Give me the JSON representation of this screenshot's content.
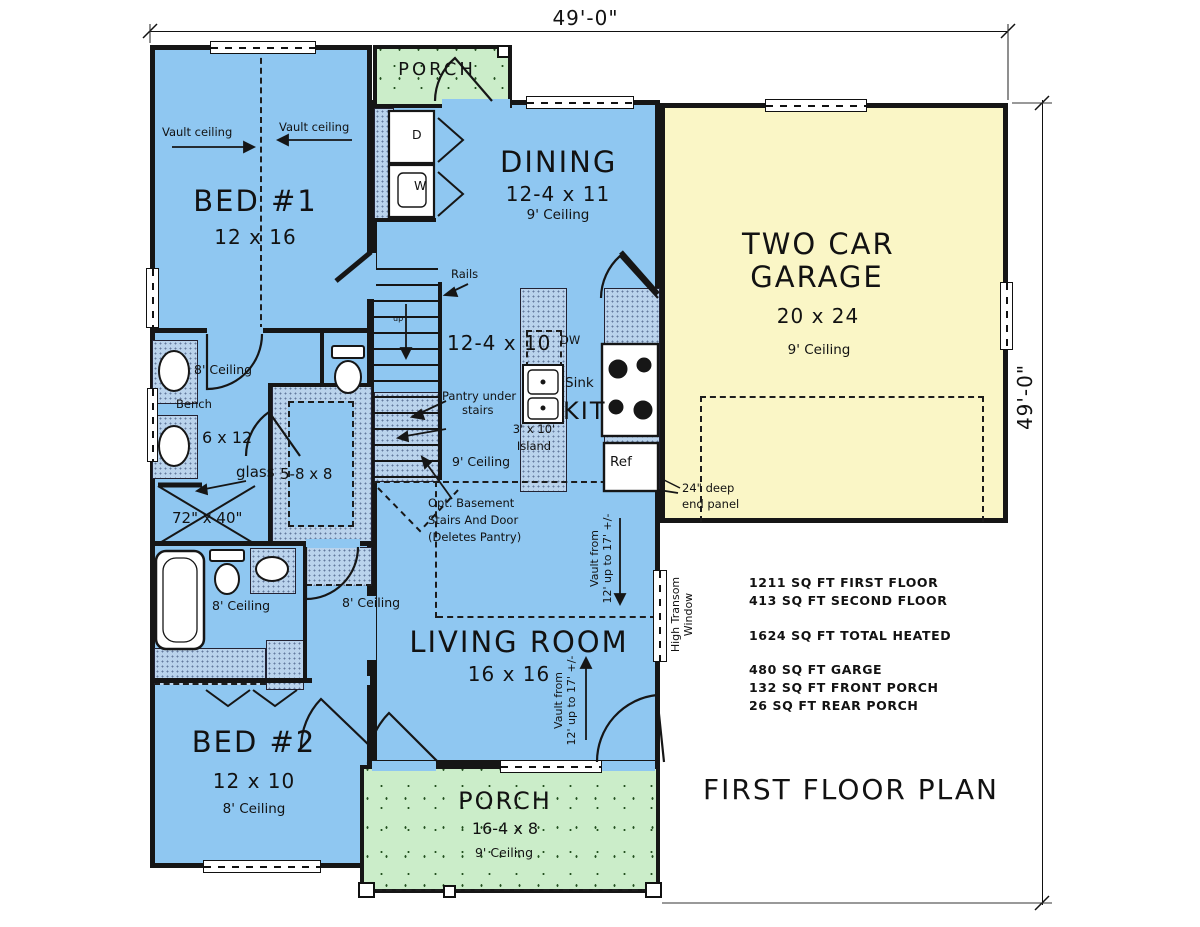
{
  "title": "FIRST FLOOR PLAN",
  "dimensions": {
    "width": "49'-0\"",
    "height": "49'-0\""
  },
  "rooms": {
    "bed1": {
      "name": "BED #1",
      "size": "12 x 16"
    },
    "bed2": {
      "name": "BED #2",
      "size": "12 x 10",
      "ceiling": "8' Ceiling"
    },
    "dining": {
      "name": "DINING",
      "size": "12-4 x 11",
      "ceiling": "9' Ceiling"
    },
    "kitchen": {
      "name": "KIT",
      "size": "12-4 x 10",
      "ceiling": "9' Ceiling",
      "island_line1": "3' x 10'",
      "island_line2": "Island"
    },
    "living": {
      "name": "LIVING ROOM",
      "size": "16 x 16"
    },
    "garage": {
      "name_line1": "TWO CAR",
      "name_line2": "GARAGE",
      "size": "20 x 24",
      "ceiling": "9' Ceiling"
    },
    "porch_front": {
      "name": "PORCH",
      "size": "16-4 x 8",
      "ceiling": "9' Ceiling"
    },
    "porch_rear": {
      "name": "PORCH"
    },
    "master_bath": {
      "ceiling": "8' Ceiling",
      "size": "6 x 12",
      "bench": "Bench",
      "glass": "glass",
      "shower_size": "72\" x 40\""
    },
    "closet": {
      "size": "5-8 x 8"
    },
    "bath2": {
      "ceiling": "8' Ceiling"
    },
    "hall": {
      "ceiling": "8' Ceiling"
    }
  },
  "appliances": {
    "dryer": "D",
    "washer": "W",
    "dishwasher": "DW",
    "sink": "Sink",
    "fridge": "Ref"
  },
  "annotations": {
    "vault_left": "Vault ceiling",
    "vault_right": "Vault ceiling",
    "rails": "Rails",
    "up": "up",
    "pantry_line1": "Pantry under",
    "pantry_line2": "stairs",
    "opt_line1": "Opt.  Basement",
    "opt_line2": "Stairs And Door",
    "opt_line3": "(Deletes Pantry)",
    "end_panel_line1": "24\" deep",
    "end_panel_line2": "end panel",
    "vault_from_line1": "Vault from",
    "vault_from_line2": "12' up to 17' +/-",
    "transom_line1": "High Transom",
    "transom_line2": "Window"
  },
  "stats": {
    "lines": [
      "1211 SQ FT FIRST FLOOR",
      "413 SQ FT SECOND FLOOR",
      "1624 SQ FT TOTAL HEATED",
      "480 SQ FT GARGE",
      "132 SQ FT FRONT PORCH",
      "26 SQ FT REAR PORCH"
    ]
  },
  "colors": {
    "floor": "#8FC7F1",
    "porch": "#CBEDC9",
    "garage": "#FAF6C6",
    "wall": "#161616",
    "cabinet": "#BAD3EC",
    "paper": "#FFFFFF"
  }
}
